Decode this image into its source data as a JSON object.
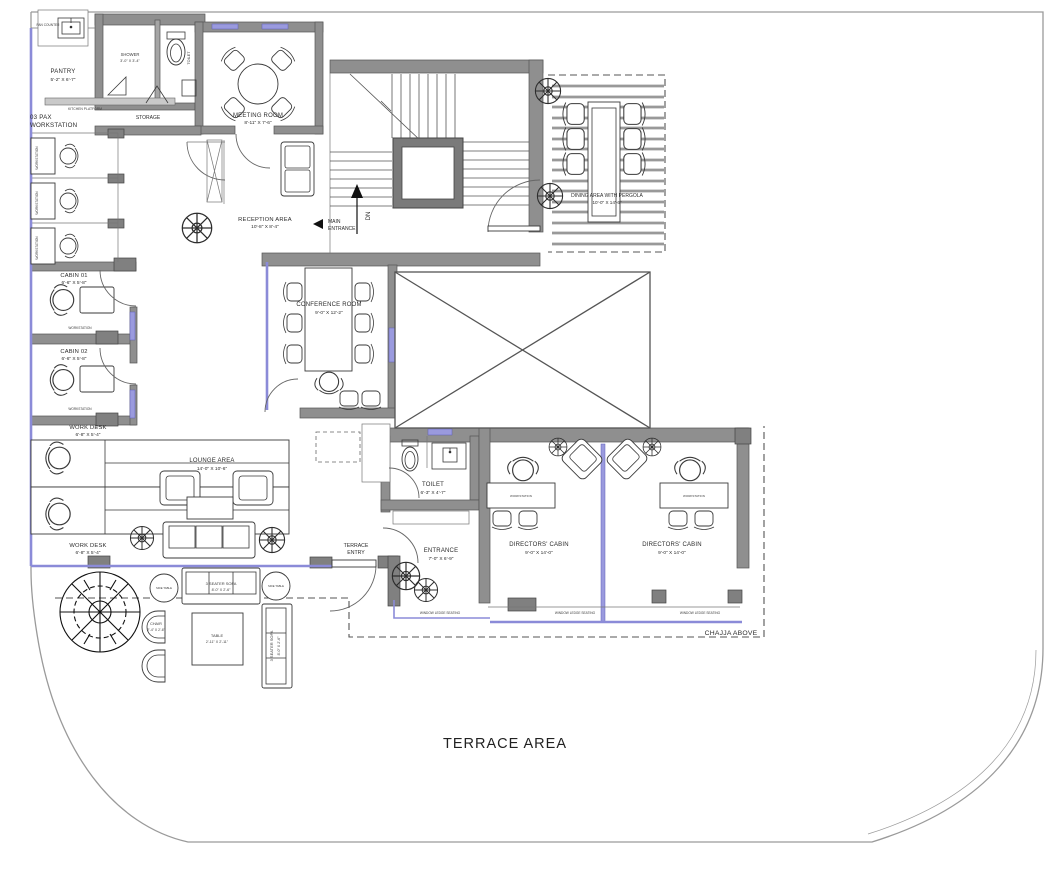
{
  "colors": {
    "wall": "#8f8f8f",
    "glass_accent": "#8b8bd8",
    "line": "#444444",
    "background": "#ffffff"
  },
  "labels": {
    "pan_counter": "PAN COUNTER",
    "kitchen_platform": "KITCHEN PLATFORM",
    "storage": "STORAGE",
    "pax_line1": "03 PAX",
    "pax_line2": "WORKSTATION",
    "workstation": "WORKSTATION",
    "dn": "DN",
    "main_entrance_line1": "MAIN",
    "main_entrance_line2": "ENTRANCE",
    "terrace_entry_line1": "TERRACE",
    "terrace_entry_line2": "ENTRY",
    "side_table": "SIDE TABLE",
    "ledge_seating": "WINDOW LEDGE SEATING",
    "chajja": "CHAJJA ABOVE",
    "terrace_area": "TERRACE AREA"
  },
  "rooms": {
    "pantry": {
      "name": "PANTRY",
      "dims": "5'-2\" X 6'-7\""
    },
    "shower": {
      "name": "SHOWER",
      "dims": "3'-0\" X 3'-4\""
    },
    "toilet_small": {
      "name": "TOILET",
      "dims": "4'-0\" X 3'-0\""
    },
    "meeting_room": {
      "name": "MEETING ROOM",
      "dims": "8'-11\" X 7'-6\""
    },
    "reception": {
      "name": "RECEPTION AREA",
      "dims": "10'-8\" X 8'-4\""
    },
    "dining": {
      "name": "DINING AREA WITH PERGOLA",
      "dims": "10'-0\" X 14'-6\""
    },
    "cabin_01": {
      "name": "CABIN 01",
      "dims": "6'-6\" X 5'-8\""
    },
    "cabin_02": {
      "name": "CABIN 02",
      "dims": "6'-6\" X 5'-8\""
    },
    "conference": {
      "name": "CONFERENCE ROOM",
      "dims": "9'-0\" X 12'-2\""
    },
    "work_desk": {
      "name": "WORK DESK",
      "dims": "6'-8\" X 5'-4\""
    },
    "lounge": {
      "name": "LOUNGE AREA",
      "dims": "14'-0\" X 10'-6\""
    },
    "toilet": {
      "name": "TOILET",
      "dims": "6'-3\" X 4'-7\""
    },
    "entrance": {
      "name": "ENTRANCE",
      "dims": "7'-0\" X 6'-9\""
    },
    "directors_cabin": {
      "name": "DIRECTORS' CABIN",
      "dims": "9'-0\" X 14'-0\""
    },
    "sofa_3seater": {
      "name": "3 SEATER SOFA",
      "dims": "8'-0\" X 2'-6\""
    },
    "chair_outdoor": {
      "name": "CHAIR",
      "dims": "2'-4\" X 2'-6\""
    },
    "table_outdoor": {
      "name": "TABLE",
      "dims": "2'-11\" X 2'-11\""
    }
  }
}
